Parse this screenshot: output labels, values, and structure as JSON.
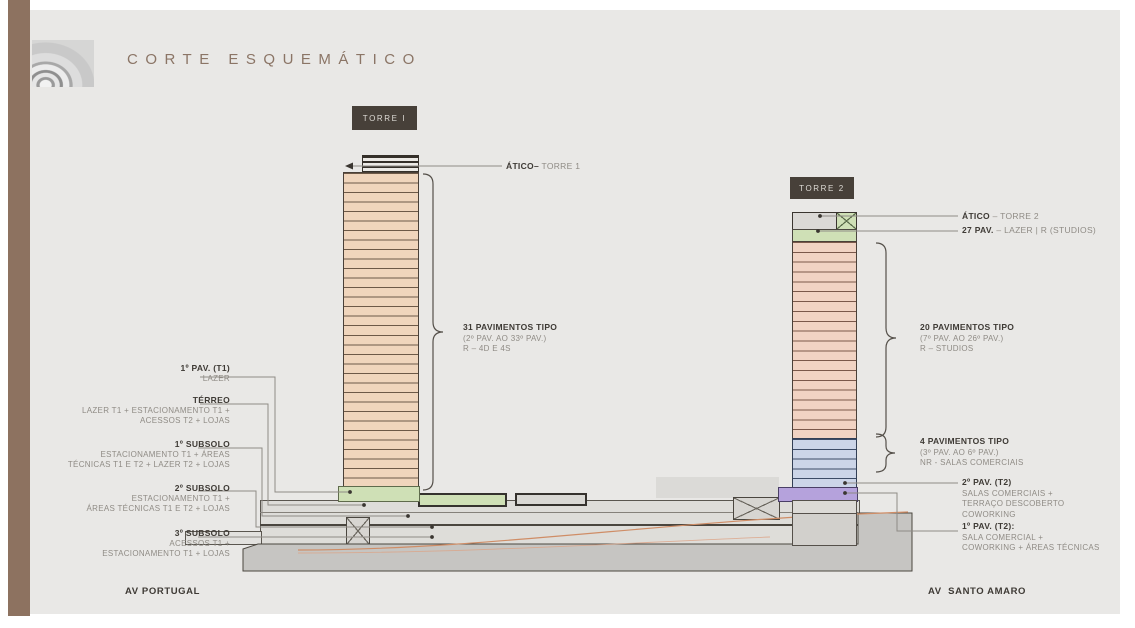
{
  "title": "CORTE ESQUEMÁTICO",
  "streets": {
    "left": "AV PORTUGAL",
    "right": "AV  SANTO AMARO"
  },
  "tower1": {
    "tag": "TORRE I",
    "atico_bold": "ÁTICO–",
    "atico_rest": " TORRE 1",
    "bracket": {
      "line1": "31 PAVIMENTOS TIPO",
      "line2": "(2º PAV. AO 33º PAV.)",
      "line3": "R – 4D E 4S"
    }
  },
  "tower2": {
    "tag": "TORRE 2",
    "atico_bold": "ÁTICO",
    "atico_rest": " – TORRE 2",
    "pav27_bold": "27 PAV.",
    "pav27_rest": " – LAZER | R (STUDIOS)",
    "bracket20": {
      "line1": "20 PAVIMENTOS TIPO",
      "line2": "(7º PAV. AO 26º PAV.)",
      "line3": "R – STUDIOS"
    },
    "bracket4": {
      "line1": "4 PAVIMENTOS TIPO",
      "line2": "(3º PAV. AO 6º PAV.)",
      "line3": "NR - SALAS COMERCIAIS"
    },
    "pav2": {
      "title": "2º PAV. (T2)",
      "lines": [
        "SALAS COMERCIAIS +",
        "TERRAÇO DESCOBERTO",
        "COWORKING"
      ]
    },
    "pav1": {
      "title": "1º PAV. (T2):",
      "lines": [
        "SALA COMERCIAL +",
        "COWORKING + ÁREAS TÉCNICAS"
      ]
    }
  },
  "left_labels": [
    {
      "title": "1º PAV. (T1)",
      "lines": [
        "LAZER"
      ]
    },
    {
      "title": "TÉRREO",
      "lines": [
        "LAZER T1 + ESTACIONAMENTO T1 +",
        "ACESSOS T2 + LOJAS"
      ]
    },
    {
      "title": "1º SUBSOLO",
      "lines": [
        "ESTACIONAMENTO T1 + ÁREAS",
        "TÉCNICAS T1 E T2 + LAZER T2 + LOJAS"
      ]
    },
    {
      "title": "2º SUBSOLO",
      "lines": [
        "ESTACIONAMENTO T1 +",
        "ÁREAS TÉCNICAS T1 E T2 + LOJAS"
      ]
    },
    {
      "title": "3º SUBSOLO",
      "lines": [
        "ACESSOS T1 +",
        "ESTACIONAMENTO T1 + LOJAS"
      ]
    }
  ],
  "figure": {
    "stripe_counts": {
      "tower1": 33,
      "tower2_residential": 20,
      "tower2_commercial": 5
    },
    "colors": {
      "accent_brown": "#8d7260",
      "title_text": "#8b7566",
      "tag_bg": "#474039",
      "floor_salmon": "#f0d5bc",
      "floor_salmon_t2": "#f1d3c3",
      "floor_green": "#cfe0b6",
      "floor_blue": "#ccd5e8",
      "floor_purple": "#b5a2dc",
      "ground_gray": "#c6c5c2",
      "ramp_orange": "#cf8d66"
    }
  }
}
